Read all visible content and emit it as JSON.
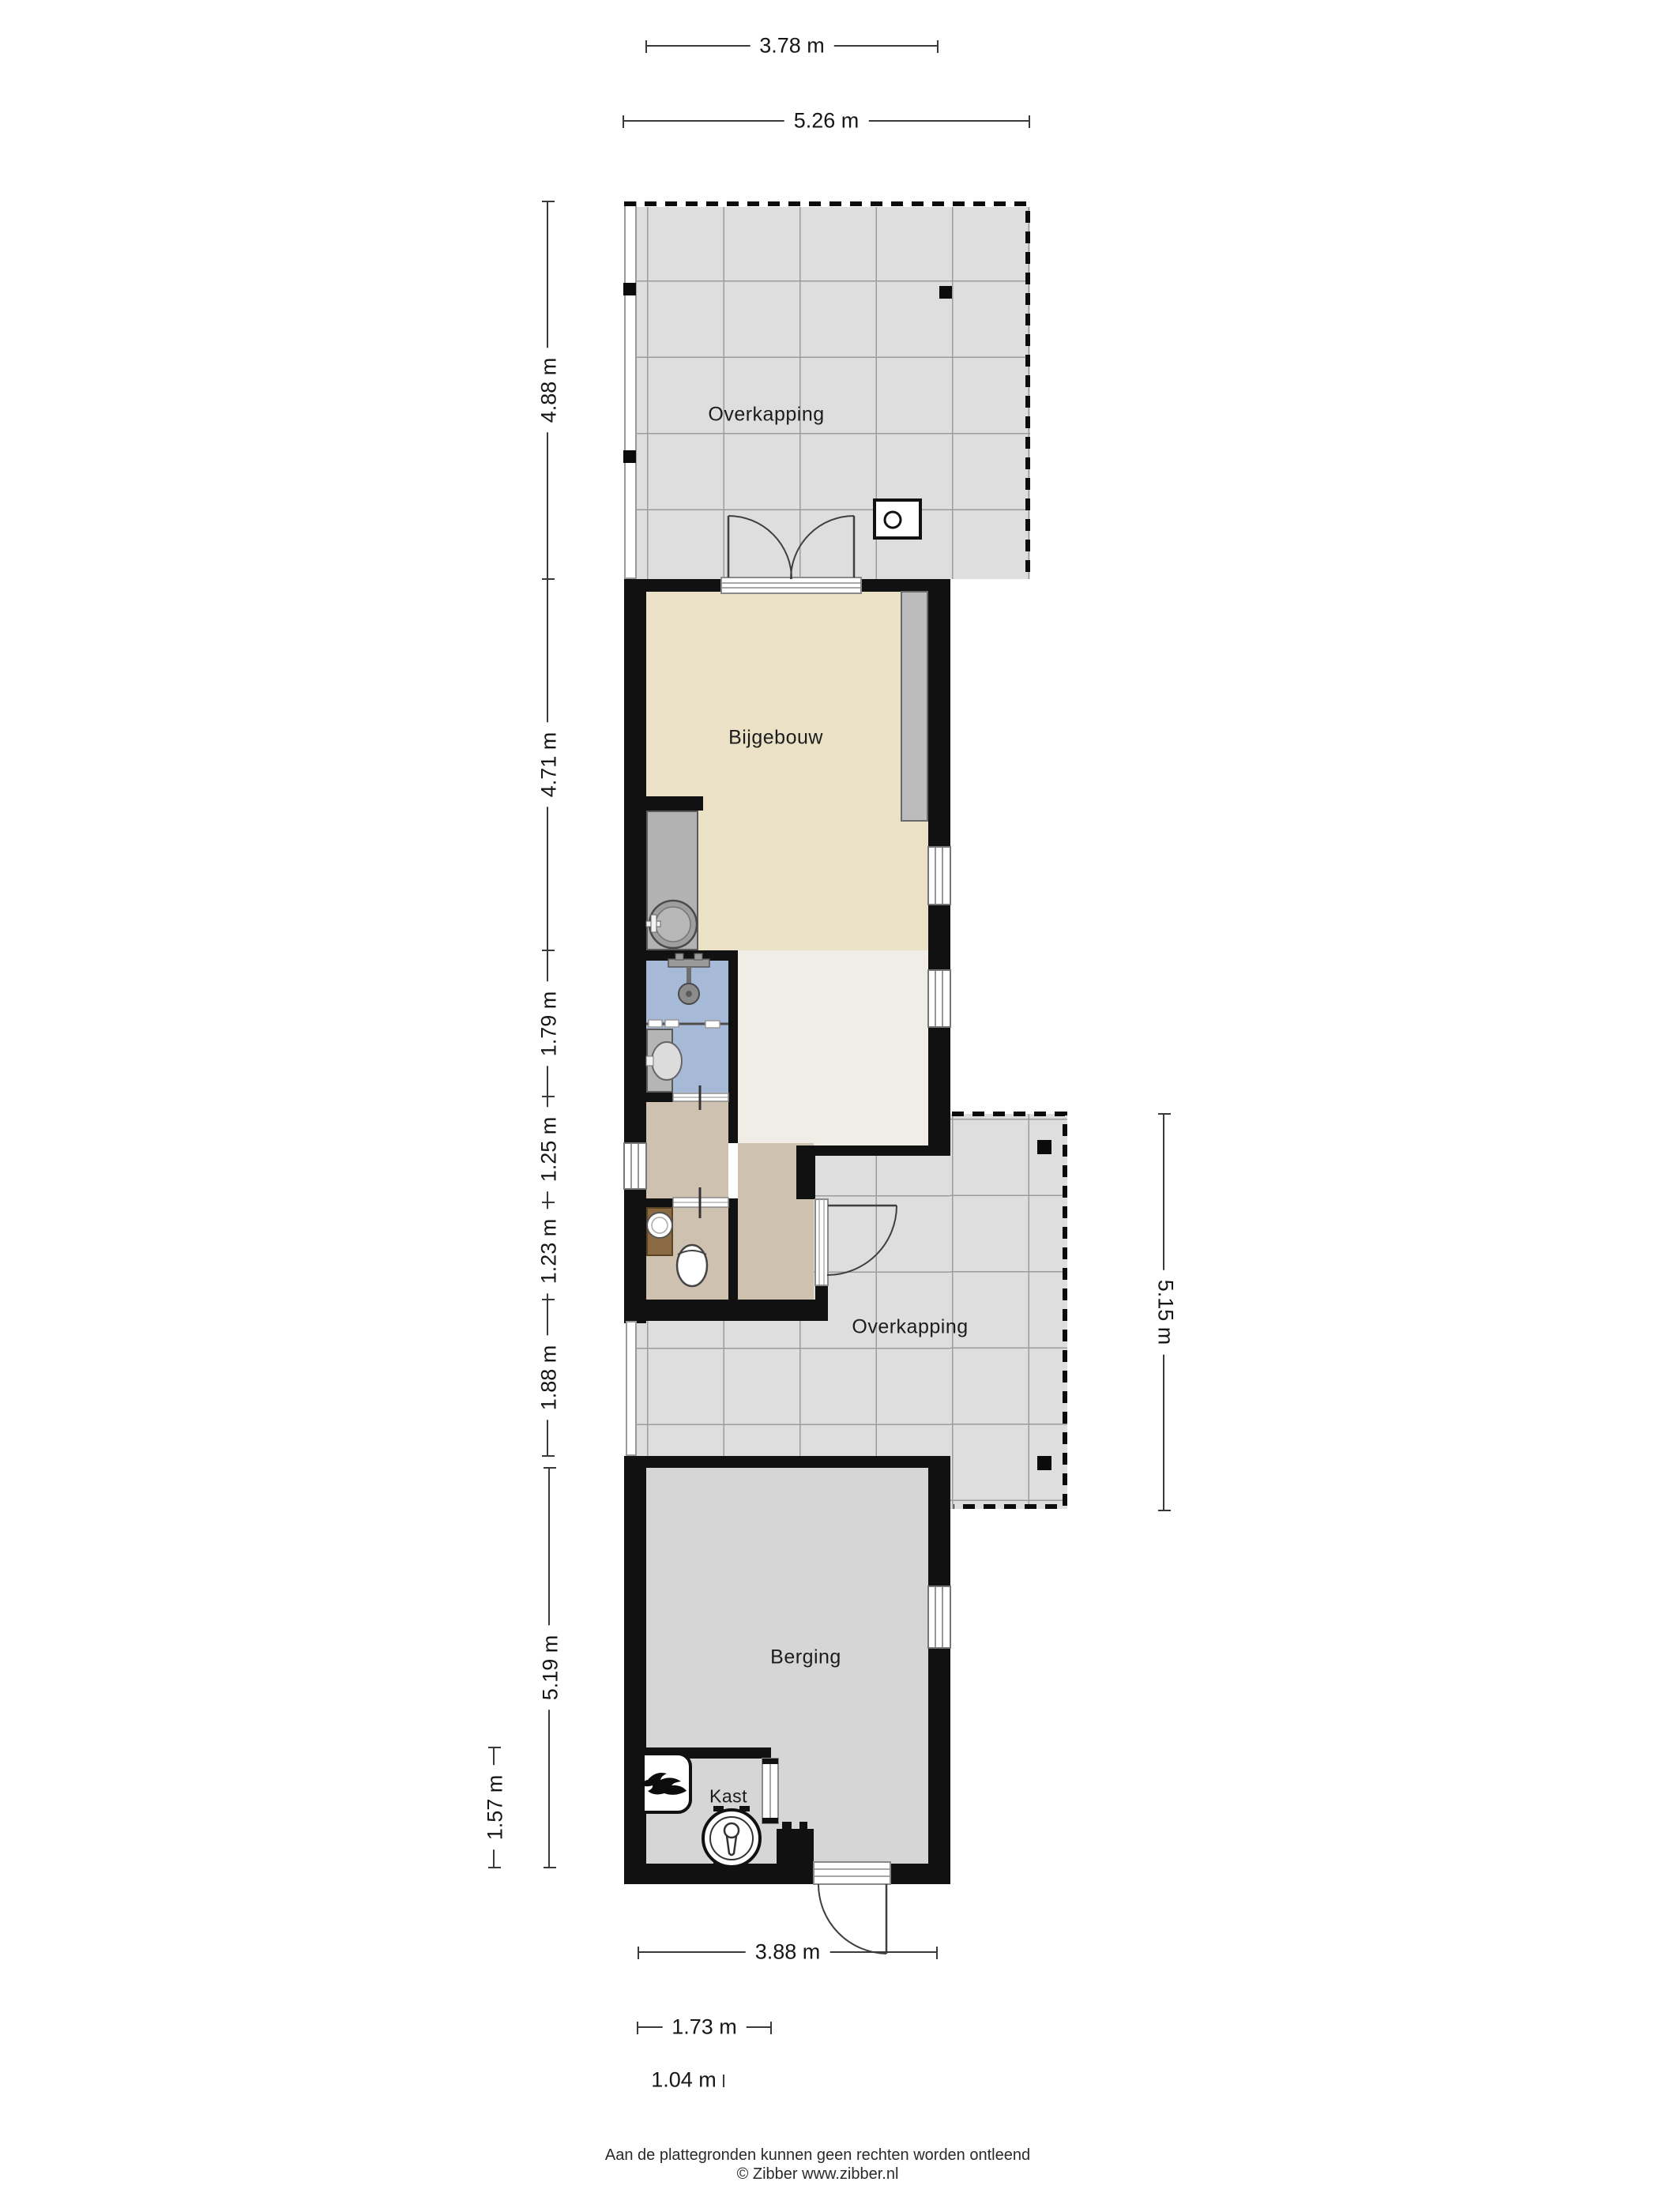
{
  "plan": {
    "rooms": {
      "overkapping_top": "Overkapping",
      "bijgebouw": "Bijgebouw",
      "overkapping_side": "Overkapping",
      "berging": "Berging",
      "kast": "Kast"
    },
    "dims": {
      "d378": "3.78 m",
      "d526": "5.26 m",
      "d488": "4.88 m",
      "d471": "4.71 m",
      "d179": "1.79 m",
      "d125": "1.25 m",
      "d123": "1.23 m",
      "d188": "1.88 m",
      "d519": "5.19 m",
      "d157": "1.57 m",
      "d515": "5.15 m",
      "d388": "3.88 m",
      "d173": "1.73 m",
      "d104": "1.04 m"
    },
    "footer": {
      "line1": "Aan de plattegronden kunnen geen rechten worden ontleend",
      "line2": "© Zibber www.zibber.nl"
    },
    "colors": {
      "wall": "#111111",
      "overkapping_floor": "#dedede",
      "bijgebouw_floor": "#eae1c6",
      "hall_floor": "#cfc1b0",
      "wet_room_floor": "#a6bad7",
      "berging_floor": "#d6d6d6",
      "white_floor": "#efede5"
    }
  }
}
